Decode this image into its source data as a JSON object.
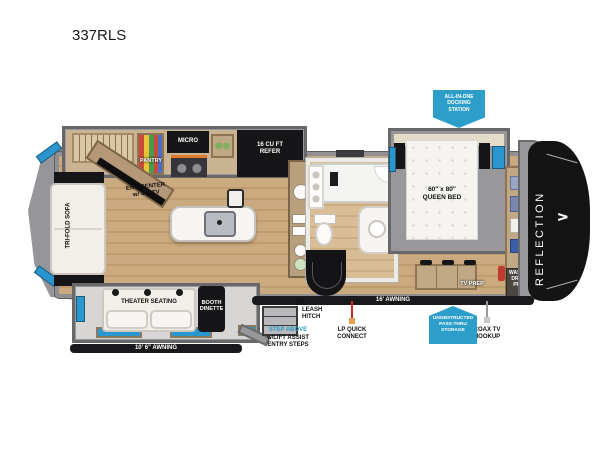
{
  "title": "337RLS",
  "brand": {
    "name": "REFLECTION",
    "logo_arrow": "∧"
  },
  "callouts": {
    "docking": "ALL-IN-ONE\nDOCKING\nSTATION",
    "pass_thru": "UNOBSTRUCTED\nPASS-THRU\nSTORAGE",
    "step_above": "STEP ABOVE",
    "step_above_sub": "w/LIFT ASSIST\nENTRY STEPS",
    "leash_hitch": "LEASH\nHITCH",
    "lp_quick_connect": "LP QUICK\nCONNECT",
    "coax_tv_hookup": "COAX TV\nHOOKUP"
  },
  "awnings": {
    "main": "16' AWNING",
    "rear": "10' 6\" AWNING"
  },
  "rooms": {
    "sofa": "TRI-FOLD SOFA",
    "ent_center": "ENT. CENTER\nw/ 40\" TV",
    "pantry": "PANTRY",
    "micro": "MICRO",
    "refer": "16 CU FT\nREFER",
    "theater": "THEATER SEATING",
    "dinette": "BOOTH\nDINETTE",
    "bed": "60\" x 80\"\nQUEEN BED",
    "washer_dryer": "WASHER\nDRYER\nPREP",
    "tv_prep": "TV PREP"
  },
  "colors": {
    "badge_blue": "#2d9ec9",
    "window_blue": "#2a96cf",
    "stove_orange": "#e07a28",
    "lp_red": "#d02b20",
    "front_cap": "#141414"
  }
}
